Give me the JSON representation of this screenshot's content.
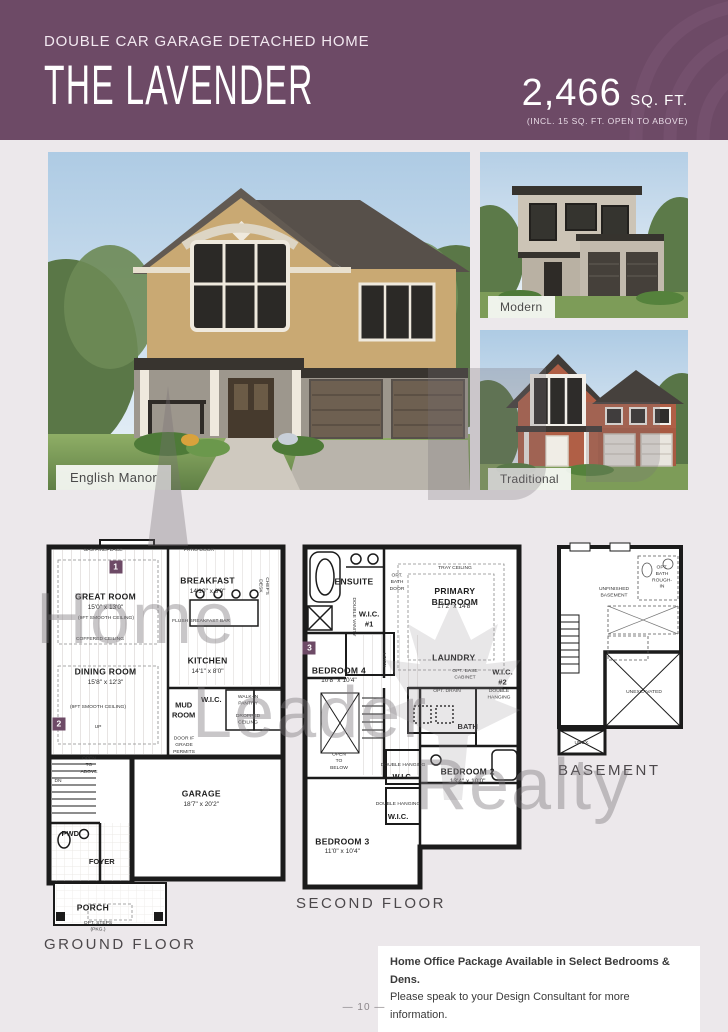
{
  "header": {
    "subtitle": "DOUBLE CAR GARAGE DETACHED HOME",
    "title": "THE LAVENDER",
    "sqft_value": "2,466",
    "sqft_unit": "SQ. FT.",
    "sqft_note": "(INCL. 15 SQ. FT. OPEN TO ABOVE)",
    "brand_color": "#6d4a66"
  },
  "elevations": [
    {
      "label": "English Manor"
    },
    {
      "label": "Modern"
    },
    {
      "label": "Traditional"
    }
  ],
  "watermark": {
    "word1": "Home",
    "word2": "Leader",
    "word3": "Realty"
  },
  "plans": {
    "ground": {
      "caption": "GROUND FLOOR",
      "labels": [
        {
          "t": "GAS FIREPLACE",
          "x": 25,
          "y": 3.2,
          "c": "note"
        },
        {
          "t": "PATIO DOOR",
          "x": 63,
          "y": 3.2,
          "c": "note"
        },
        {
          "t": "1",
          "x": 30,
          "y": 7.2,
          "c": "marker"
        },
        {
          "t": "GREAT ROOM",
          "x": 26,
          "y": 14.8,
          "c": "room"
        },
        {
          "t": "15'0\" x 13'0\"",
          "x": 26,
          "y": 17.6,
          "c": "dim"
        },
        {
          "t": "(9FT SMOOTH CEILING)",
          "x": 26,
          "y": 20.2,
          "c": "note"
        },
        {
          "t": "BREAKFAST",
          "x": 66.5,
          "y": 10.8,
          "c": "room"
        },
        {
          "t": "14'10\" x 8'0\"",
          "x": 66.5,
          "y": 13.6,
          "c": "dim"
        },
        {
          "t": "CHEF'S DESK",
          "x": 88.5,
          "y": 12,
          "c": "notev"
        },
        {
          "t": "FLUSH BREAKFAST BAR",
          "x": 64,
          "y": 21,
          "c": "note"
        },
        {
          "t": "KITCHEN",
          "x": 66.5,
          "y": 30.8,
          "c": "room"
        },
        {
          "t": "14'1\" x 8'0\"",
          "x": 66.5,
          "y": 33.4,
          "c": "dim"
        },
        {
          "t": "COFFERED CEILING",
          "x": 24,
          "y": 25.4,
          "c": "note"
        },
        {
          "t": "DINING ROOM",
          "x": 26,
          "y": 33.4,
          "c": "room"
        },
        {
          "t": "15'8\" x 12'3\"",
          "x": 26,
          "y": 36.2,
          "c": "dim"
        },
        {
          "t": "(9FT SMOOTH CEILING)",
          "x": 23,
          "y": 42.4,
          "c": "note"
        },
        {
          "t": "MUD\nROOM",
          "x": 57,
          "y": 43,
          "c": "room-sm"
        },
        {
          "t": "W.I.C.",
          "x": 68,
          "y": 40.6,
          "c": "room-sm"
        },
        {
          "t": "WALK-IN\nPANTRY",
          "x": 82.5,
          "y": 40.8,
          "c": "note"
        },
        {
          "t": "DROPPED CEILING",
          "x": 82.5,
          "y": 45.4,
          "c": "note"
        },
        {
          "t": "2",
          "x": 7.5,
          "y": 46.4,
          "c": "marker"
        },
        {
          "t": "UP",
          "x": 23,
          "y": 47.5,
          "c": "note"
        },
        {
          "t": "DN",
          "x": 7,
          "y": 61,
          "c": "note"
        },
        {
          "t": "OPEN\nTO\nABOVE",
          "x": 19.5,
          "y": 57,
          "c": "note"
        },
        {
          "t": "DOOR IF\nGRADE\nPERMITS",
          "x": 57,
          "y": 52,
          "c": "note"
        },
        {
          "t": "GARAGE",
          "x": 64,
          "y": 64,
          "c": "room"
        },
        {
          "t": "18'7\" x 20'2\"",
          "x": 64,
          "y": 66.8,
          "c": "dim"
        },
        {
          "t": "PWD",
          "x": 12,
          "y": 74,
          "c": "room-sm"
        },
        {
          "t": "FOYER",
          "x": 24.5,
          "y": 81,
          "c": "room-sm"
        },
        {
          "t": "PORCH",
          "x": 21,
          "y": 92.5,
          "c": "room"
        },
        {
          "t": "OPT. STEPS\n(PKG.)",
          "x": 23,
          "y": 97.2,
          "c": "note"
        }
      ]
    },
    "second": {
      "caption": "SECOND FLOOR",
      "labels": [
        {
          "t": "ENSUITE",
          "x": 25,
          "y": 12.2,
          "c": "room"
        },
        {
          "t": "OPT.\nBATH\nDOOR",
          "x": 43.5,
          "y": 12.5,
          "c": "note"
        },
        {
          "t": "TRAY CEILING",
          "x": 68.5,
          "y": 8.6,
          "c": "note"
        },
        {
          "t": "PRIMARY BEDROOM",
          "x": 68.5,
          "y": 16.4,
          "c": "room"
        },
        {
          "t": "17'2\" x 14'8\"",
          "x": 68.5,
          "y": 19.2,
          "c": "dim"
        },
        {
          "t": "DOUBLE VANITY",
          "x": 24.5,
          "y": 22,
          "c": "notev"
        },
        {
          "t": "W.I.C.\n#1",
          "x": 31.5,
          "y": 22.5,
          "c": "room-sm"
        },
        {
          "t": "3",
          "x": 5.8,
          "y": 30.6,
          "c": "marker"
        },
        {
          "t": "BEDROOM 4",
          "x": 18.5,
          "y": 37,
          "c": "room"
        },
        {
          "t": "10'8\" x 10'4\"",
          "x": 18.5,
          "y": 39.8,
          "c": "dim"
        },
        {
          "t": "LINEN",
          "x": 37.5,
          "y": 34,
          "c": "notev"
        },
        {
          "t": "LAUNDRY",
          "x": 68,
          "y": 33.3,
          "c": "room"
        },
        {
          "t": "OPT. BASE\nCABINET",
          "x": 73,
          "y": 38,
          "c": "note"
        },
        {
          "t": "OPT. DRAIN",
          "x": 65,
          "y": 42.8,
          "c": "note"
        },
        {
          "t": "W.I.C. #2",
          "x": 89,
          "y": 38.6,
          "c": "room-sm"
        },
        {
          "t": "DOUBLE HANGING",
          "x": 87.5,
          "y": 43.6,
          "c": "note"
        },
        {
          "t": "BATH",
          "x": 74,
          "y": 52.5,
          "c": "room-sm"
        },
        {
          "t": "OPEN\nTO\nBELOW",
          "x": 18.5,
          "y": 62.2,
          "c": "note"
        },
        {
          "t": "DOUBLE HANGING",
          "x": 46,
          "y": 63.2,
          "c": "note"
        },
        {
          "t": "W.I.C.",
          "x": 46,
          "y": 66.5,
          "c": "room-sm"
        },
        {
          "t": "BEDROOM 2",
          "x": 74,
          "y": 65,
          "c": "room"
        },
        {
          "t": "13'4\" x 10'0\"",
          "x": 74,
          "y": 67.8,
          "c": "dim"
        },
        {
          "t": "DOUBLE HANGING",
          "x": 44,
          "y": 74.3,
          "c": "note"
        },
        {
          "t": "W.I.C.",
          "x": 44,
          "y": 77.6,
          "c": "room-sm"
        },
        {
          "t": "BEDROOM 3",
          "x": 20,
          "y": 84.4,
          "c": "room"
        },
        {
          "t": "11'0\" x 10'4\"",
          "x": 20,
          "y": 87.2,
          "c": "dim"
        }
      ]
    },
    "basement": {
      "caption": "BASEMENT",
      "labels": [
        {
          "t": "UNFINISHED\nBASEMENT",
          "x": 46,
          "y": 24,
          "c": "note"
        },
        {
          "t": "OPT. BATH\nROUGH-IN",
          "x": 80,
          "y": 17,
          "c": "note"
        },
        {
          "t": "UNEXCAVATED",
          "x": 67,
          "y": 69,
          "c": "note"
        },
        {
          "t": "UNEX.",
          "x": 23,
          "y": 92,
          "c": "note"
        }
      ]
    }
  },
  "footer": {
    "note_line1": "Home Office Package Available in Select Bedrooms & Dens.",
    "note_line2": "Please speak to your Design Consultant for more information.",
    "page_number": "—  10  —"
  }
}
